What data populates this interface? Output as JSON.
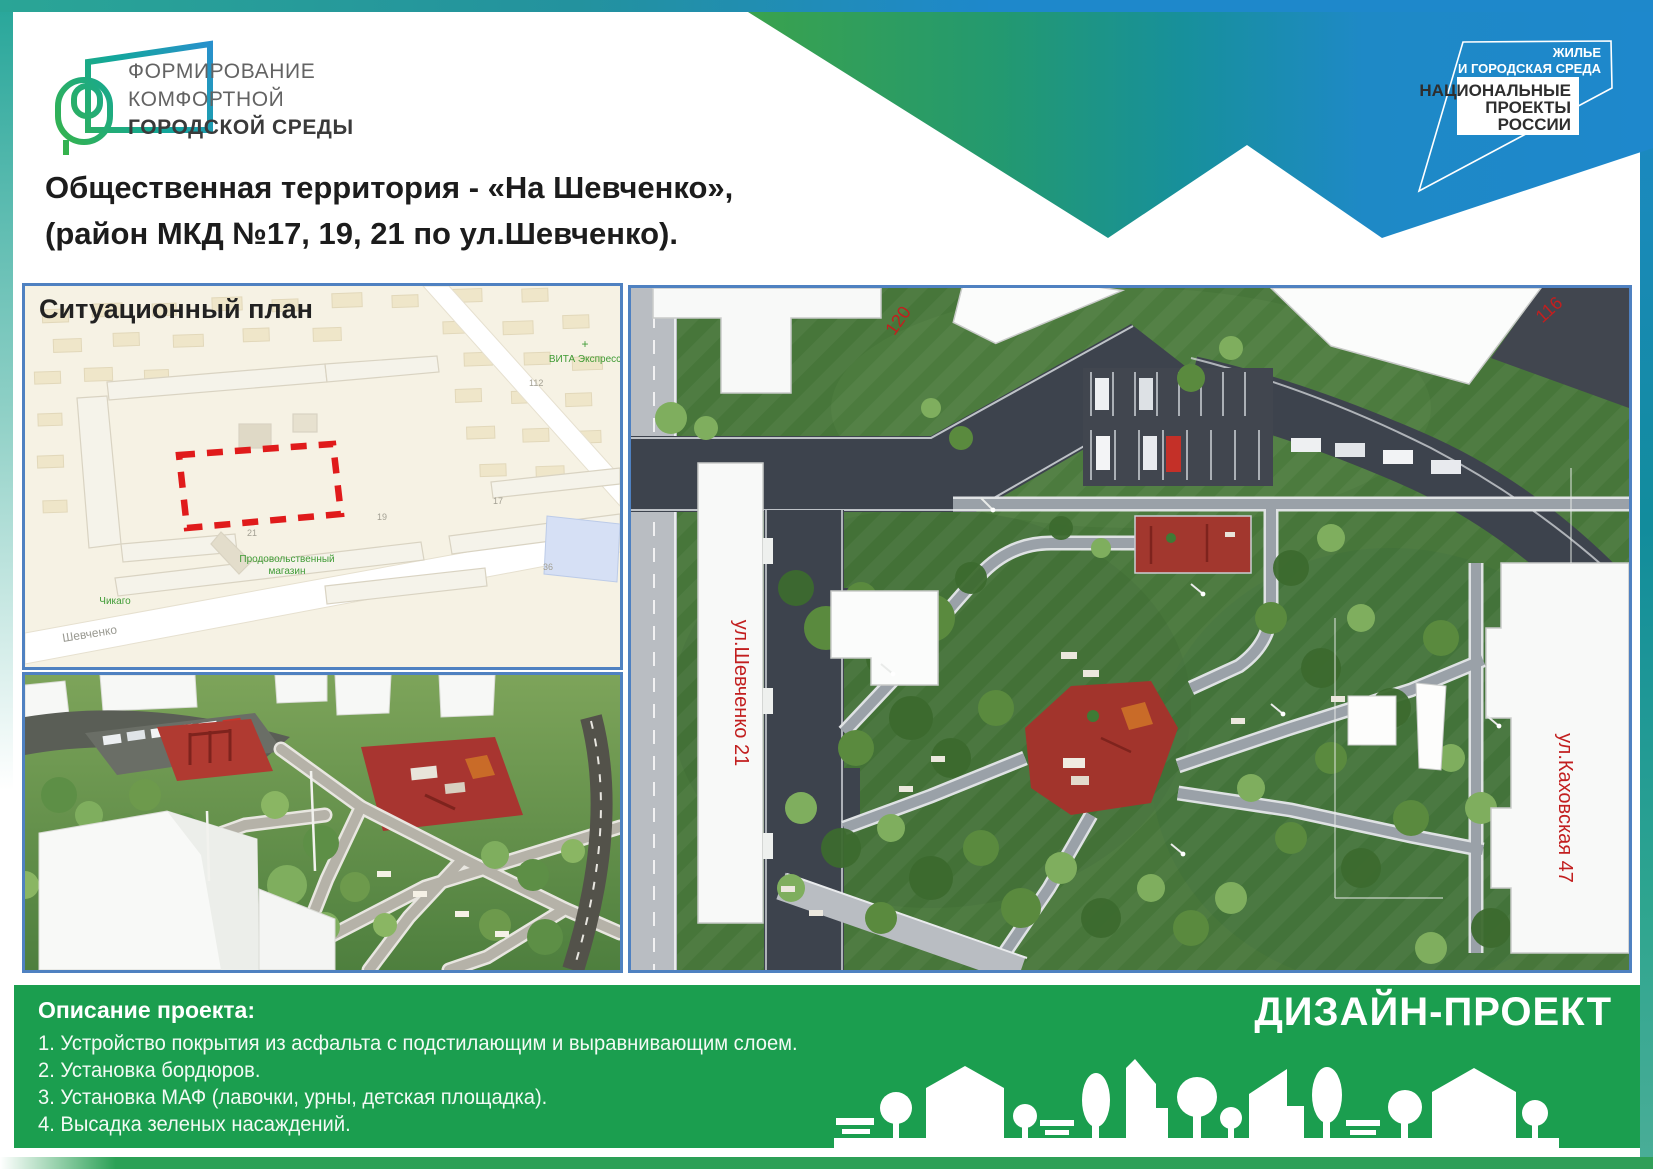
{
  "brand": {
    "program_line1": "ФОРМИРОВАНИЕ",
    "program_line2": "КОМФОРТНОЙ",
    "program_line3": "ГОРОДСКОЙ СРЕДЫ"
  },
  "national_badge": {
    "line1": "ЖИЛЬЕ",
    "line2": "И ГОРОДСКАЯ СРЕДА",
    "line3": "НАЦИОНАЛЬНЫЕ",
    "line4": "ПРОЕКТЫ",
    "line5": "РОССИИ"
  },
  "title": {
    "line1": "Общественная территория - «На Шевченко»,",
    "line2": "(район МКД №17, 19, 21 по ул.Шевченко)."
  },
  "map": {
    "title": "Ситуационный план",
    "street": "Шевченко",
    "poi_grocery_line1": "Продовольственный",
    "poi_grocery_line2": "магазин",
    "poi_chicago": "Чикаго",
    "poi_vita": "ВИТА Экспресс",
    "numbers": {
      "n21": "21",
      "n19": "19",
      "n17": "17",
      "n36": "36",
      "n112": "112"
    }
  },
  "aerial": {
    "label_shevchenko21": "ул.Шевченко 21",
    "label_120": "120",
    "label_116": "116",
    "label_kakhovskaya47": "ул.Каховская 47"
  },
  "footer": {
    "heading": "Описание проекта:",
    "items": [
      "1.  Устройство покрытия из  асфальта с подстилающим и выравнивающим слоем.",
      "2.  Установка бордюров.",
      "3.  Установка МАФ (лавочки, урны, детская площадка).",
      "4. Высадка зеленых насаждений."
    ],
    "design_label": "ДИЗАЙН-ПРОЕКТ"
  },
  "colors": {
    "footer_green": "#1b9e4f",
    "panel_border_blue": "#4f81c1",
    "accent_red": "#e11d1d",
    "swoosh_green": "#3aa24d",
    "swoosh_blue": "#1e88cc",
    "logo_teal": "#19a89b"
  }
}
